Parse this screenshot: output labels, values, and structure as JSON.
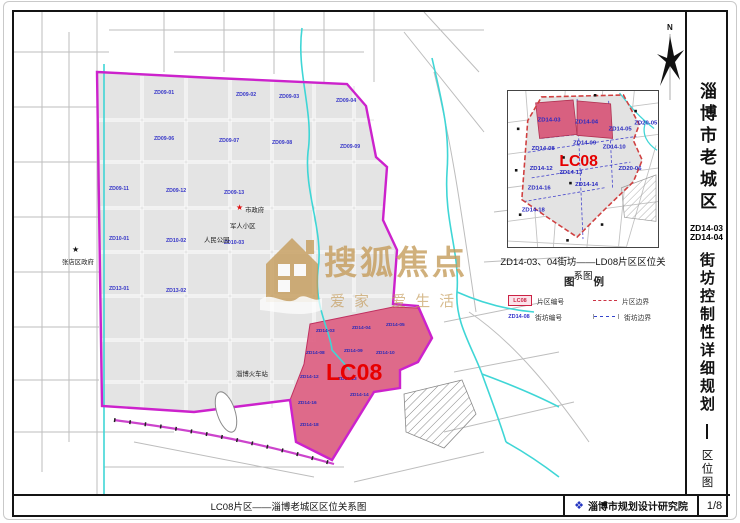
{
  "colors": {
    "boundary_magenta": "#cc22cc",
    "lc08_pink": "#dd5f82",
    "lc08_text_red": "#e80000",
    "block_label_blue": "#3636c8",
    "river_cyan": "#3fd6d6",
    "watermark_tan": "#c49a58",
    "inset_boundary_red": "#d04040",
    "logo_blue": "#2335c0"
  },
  "title_block": {
    "title_main": "淄博市老城区",
    "code_line1": "ZD14-03",
    "code_line2": "ZD14-04",
    "title_sub": "街坊控制性详细规划",
    "dash": "—",
    "title_type": "区位图"
  },
  "bottom_bar": {
    "caption": "LC08片区——淄博老城区区位关系图",
    "institute": "淄博市规划设计研究院",
    "institute_logo": "❖",
    "page_number": "1/8"
  },
  "compass": {
    "label": "N"
  },
  "watermark": {
    "brand": "搜狐焦点",
    "slogan": "爱家 爱生活"
  },
  "main_map": {
    "lc08_label": "LC08",
    "places": [
      {
        "name": "张店区政府"
      },
      {
        "name": "市政府"
      },
      {
        "name": "军人小区"
      },
      {
        "name": "人民公园"
      },
      {
        "name": "淄博火车站"
      }
    ],
    "blocks": [
      {
        "code": "ZD09-01"
      },
      {
        "code": "ZD09-02"
      },
      {
        "code": "ZD09-03"
      },
      {
        "code": "ZD09-04"
      },
      {
        "code": "ZD09-06"
      },
      {
        "code": "ZD09-07"
      },
      {
        "code": "ZD09-08"
      },
      {
        "code": "ZD09-09"
      },
      {
        "code": "ZD09-11"
      },
      {
        "code": "ZD09-12"
      },
      {
        "code": "ZD09-13"
      },
      {
        "code": "ZD10-01"
      },
      {
        "code": "ZD10-02"
      },
      {
        "code": "ZD10-03"
      },
      {
        "code": "ZD13-01"
      },
      {
        "code": "ZD13-02"
      }
    ],
    "lc08_blocks": [
      {
        "code": "ZD14-03"
      },
      {
        "code": "ZD14-04"
      },
      {
        "code": "ZD14-05"
      },
      {
        "code": "ZD14-08"
      },
      {
        "code": "ZD14-09"
      },
      {
        "code": "ZD14-10"
      },
      {
        "code": "ZD14-12"
      },
      {
        "code": "ZD14-13"
      },
      {
        "code": "ZD14-14"
      },
      {
        "code": "ZD14-16"
      },
      {
        "code": "ZD14-18"
      }
    ]
  },
  "inset": {
    "caption": "ZD14-03、04街坊——LD08片区区位关系图",
    "lc08_label": "LC08",
    "blocks": [
      {
        "code": "ZD14-03"
      },
      {
        "code": "ZD14-04"
      },
      {
        "code": "ZD14-05"
      },
      {
        "code": "ZD20-05"
      },
      {
        "code": "ZD14-09"
      },
      {
        "code": "ZD14-10"
      },
      {
        "code": "ZD14-08"
      },
      {
        "code": "ZD14-12"
      },
      {
        "code": "ZD14-13"
      },
      {
        "code": "ZD20-06"
      },
      {
        "code": "ZD14-16"
      },
      {
        "code": "ZD14-14"
      },
      {
        "code": "ZD14-18"
      }
    ]
  },
  "legend": {
    "title": "图 例",
    "district_code_symbol": "LC08",
    "district_code_label": "片区编号",
    "block_code_symbol": "ZD14-08",
    "block_code_label": "街坊编号",
    "district_boundary_label": "片区边界",
    "block_boundary_label": "街坊边界"
  }
}
